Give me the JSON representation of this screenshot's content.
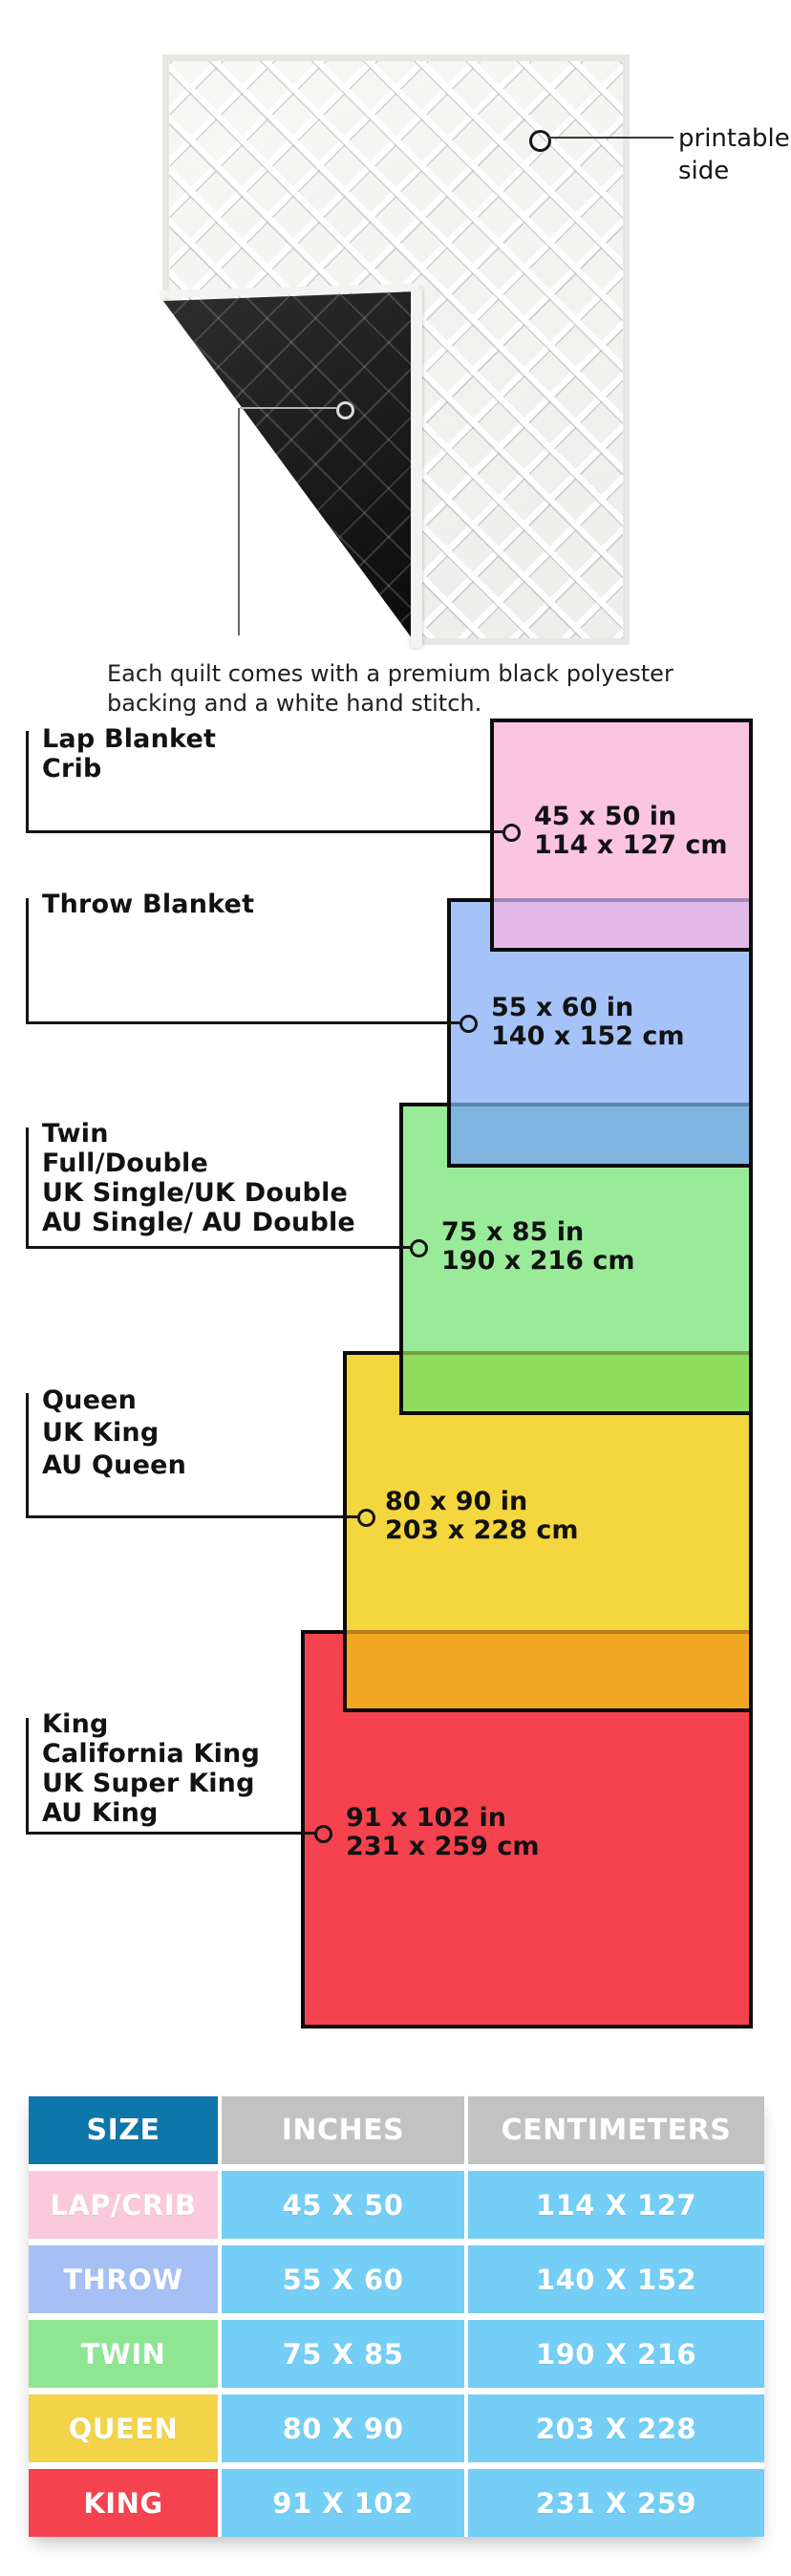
{
  "quilt_section": {
    "printable_label_line1": "printable",
    "printable_label_line2": "side",
    "caption_line1": "Each quilt comes with a premium black polyester",
    "caption_line2": "backing and a white hand stitch.",
    "front_color": "#f4f4f2",
    "backing_color": "#141414"
  },
  "size_diagram": {
    "groups": [
      {
        "name": "lap-crib",
        "label_lines": [
          "Lap Blanket",
          "Crib"
        ],
        "inches": "45 x 50 in",
        "cm": "114 x 127 cm",
        "color": "#FBC5E0",
        "overlap_color": "#E2B9E6"
      },
      {
        "name": "throw",
        "label_lines": [
          "Throw Blanket"
        ],
        "inches": "55 x 60 in",
        "cm": "140 x 152 cm",
        "color": "#A5C3F8",
        "overlap_color": "#7FB5E0"
      },
      {
        "name": "twin",
        "label_lines": [
          "Twin",
          "Full/Double",
          "UK Single/UK Double",
          "AU Single/ AU Double"
        ],
        "inches": "75 x 85 in",
        "cm": "190 x 216 cm",
        "color": "#9AEB99",
        "overlap_color": "#8FDC5F"
      },
      {
        "name": "queen",
        "label_lines": [
          "Queen",
          "UK King",
          "AU Queen"
        ],
        "inches": "80 x 90 in",
        "cm": "203 x 228 cm",
        "color": "#F4D63F",
        "overlap_color": "#F1A722"
      },
      {
        "name": "king",
        "label_lines": [
          "King",
          "California King",
          "UK Super King",
          "AU King"
        ],
        "inches": "91 x 102 in",
        "cm": "231 x 259 cm",
        "color": "#F4434F"
      }
    ],
    "border_color": "#0c0c0c"
  },
  "table": {
    "headers": [
      "SIZE",
      "INCHES",
      "CENTIMETERS"
    ],
    "header_colors": {
      "size": "#0E76A8",
      "other": "#C2C2C2"
    },
    "cell_color": "#74CEF5",
    "rows": [
      {
        "size": "LAP/CRIB",
        "inches": "45 X 50",
        "centimeters": "114 X 127",
        "label_color": "#FBC9DC"
      },
      {
        "size": "THROW",
        "inches": "55 X 60",
        "centimeters": "140 X 152",
        "label_color": "#A6BFF5"
      },
      {
        "size": "TWIN",
        "inches": "75 X 85",
        "centimeters": "190 X 216",
        "label_color": "#8EE693"
      },
      {
        "size": "QUEEN",
        "inches": "80 X 90",
        "centimeters": "203 X 228",
        "label_color": "#F3D348"
      },
      {
        "size": "KING",
        "inches": "91 X 102",
        "centimeters": "231 X 259",
        "label_color": "#F4434F"
      }
    ]
  }
}
